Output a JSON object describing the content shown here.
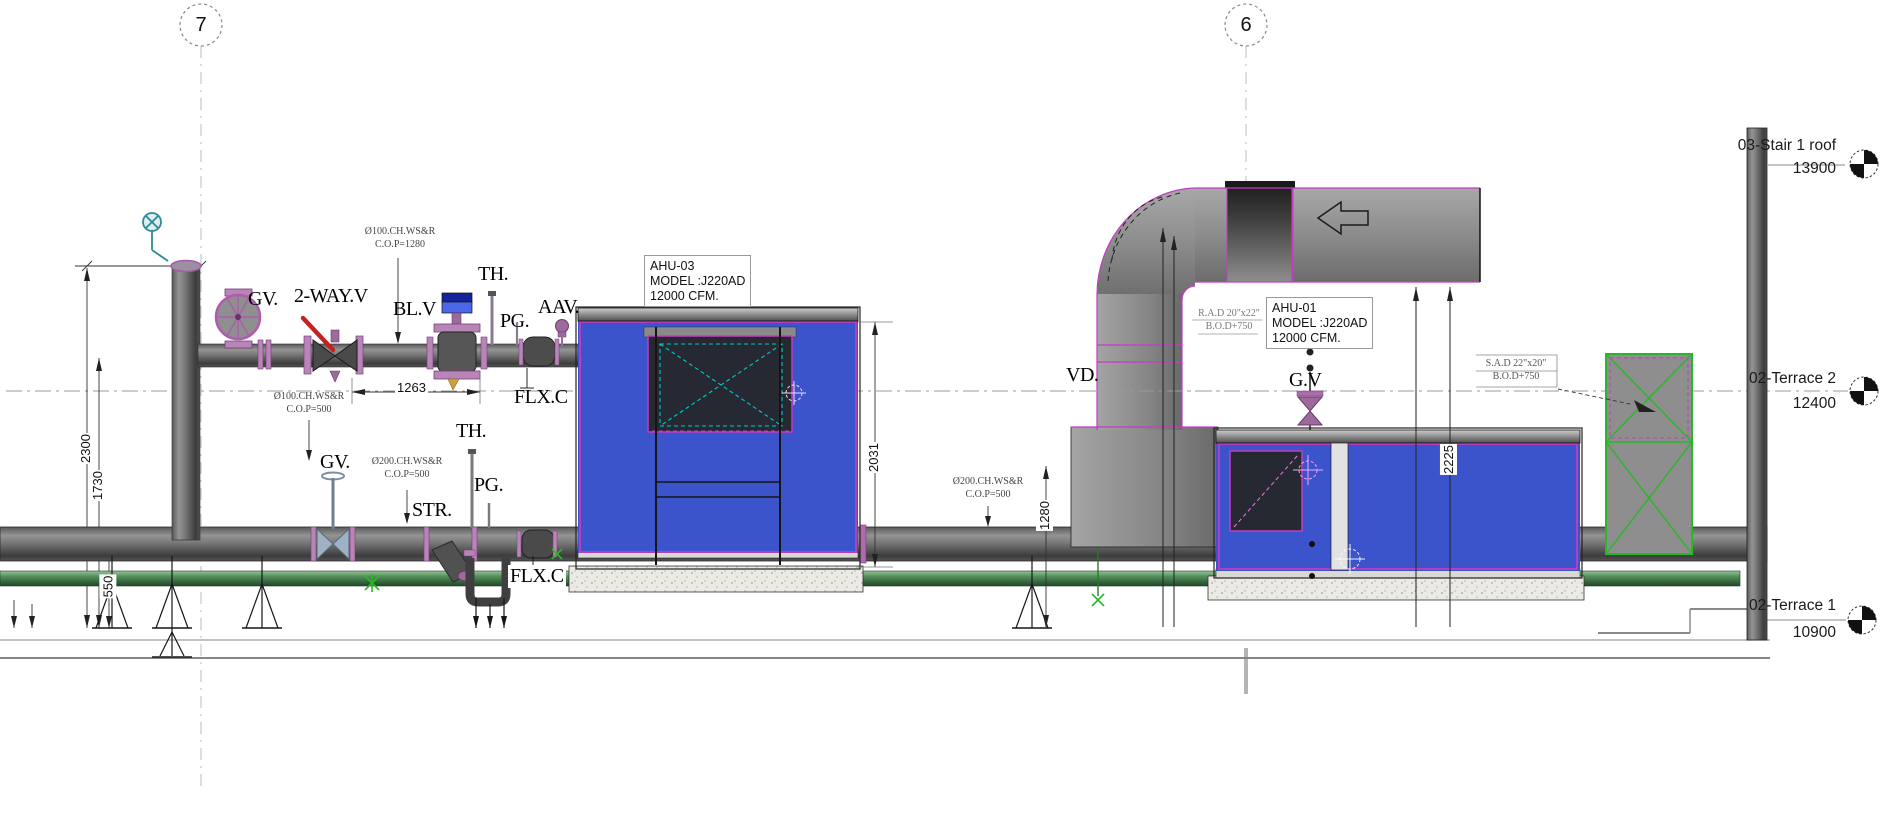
{
  "grid": {
    "g7": "7",
    "g6": "6"
  },
  "levels": {
    "stair_roof": {
      "name": "03-Stair 1 roof",
      "elev": "13900"
    },
    "terrace2": {
      "name": "02-Terrace 2",
      "elev": "12400"
    },
    "terrace1": {
      "name": "02-Terrace 1",
      "elev": "10900"
    }
  },
  "equipment": {
    "ahu03": {
      "tag": "AHU-03",
      "model": "MODEL :J220AD",
      "flow": "12000 CFM."
    },
    "ahu01": {
      "tag": "AHU-01",
      "model": "MODEL :J220AD",
      "flow": "12000 CFM."
    }
  },
  "labels": {
    "gv_top": "GV.",
    "two_way": "2-WAY.V",
    "blv": "BL.V",
    "th_top": "TH.",
    "pg_top": "PG.",
    "aav": "AAV.",
    "flxc_top": "FLX.C",
    "gv_low": "GV.",
    "str": "STR.",
    "th_low": "TH.",
    "pg_low": "PG.",
    "flxc_low": "FLX.C",
    "vd": "VD.",
    "gv_right": "G.V"
  },
  "pipe_tags": {
    "p1": {
      "l1": "Ø100.CH.WS&R",
      "l2": "C.O.P=1280"
    },
    "p2": {
      "l1": "Ø100.CH.WS&R",
      "l2": "C.O.P=500"
    },
    "p3": {
      "l1": "Ø200.CH.WS&R",
      "l2": "C.O.P=500"
    },
    "p4": {
      "l1": "Ø200.CH.WS&R",
      "l2": "C.O.P=500"
    }
  },
  "duct_tags": {
    "rad": {
      "l1": "R.A.D 20\"x22\"",
      "l2": "B.O.D+750"
    },
    "sad": {
      "l1": "S.A.D 22\"x20\"",
      "l2": "B.O.D+750"
    }
  },
  "dimensions": {
    "left_a": "2300",
    "left_b": "1730",
    "left_c": "550",
    "top_pipe": "1263",
    "ahu03_h": "2031",
    "pipe_h": "1280",
    "ahu01_h": "2225"
  },
  "colors": {
    "ahu_blue": "#3b54cb",
    "magenta": "#c23cc2",
    "duct_gray": "#8c8c8c",
    "green_pipe": "#3f7a46",
    "accent_green": "#28b828",
    "cyan": "#00c8c8"
  }
}
